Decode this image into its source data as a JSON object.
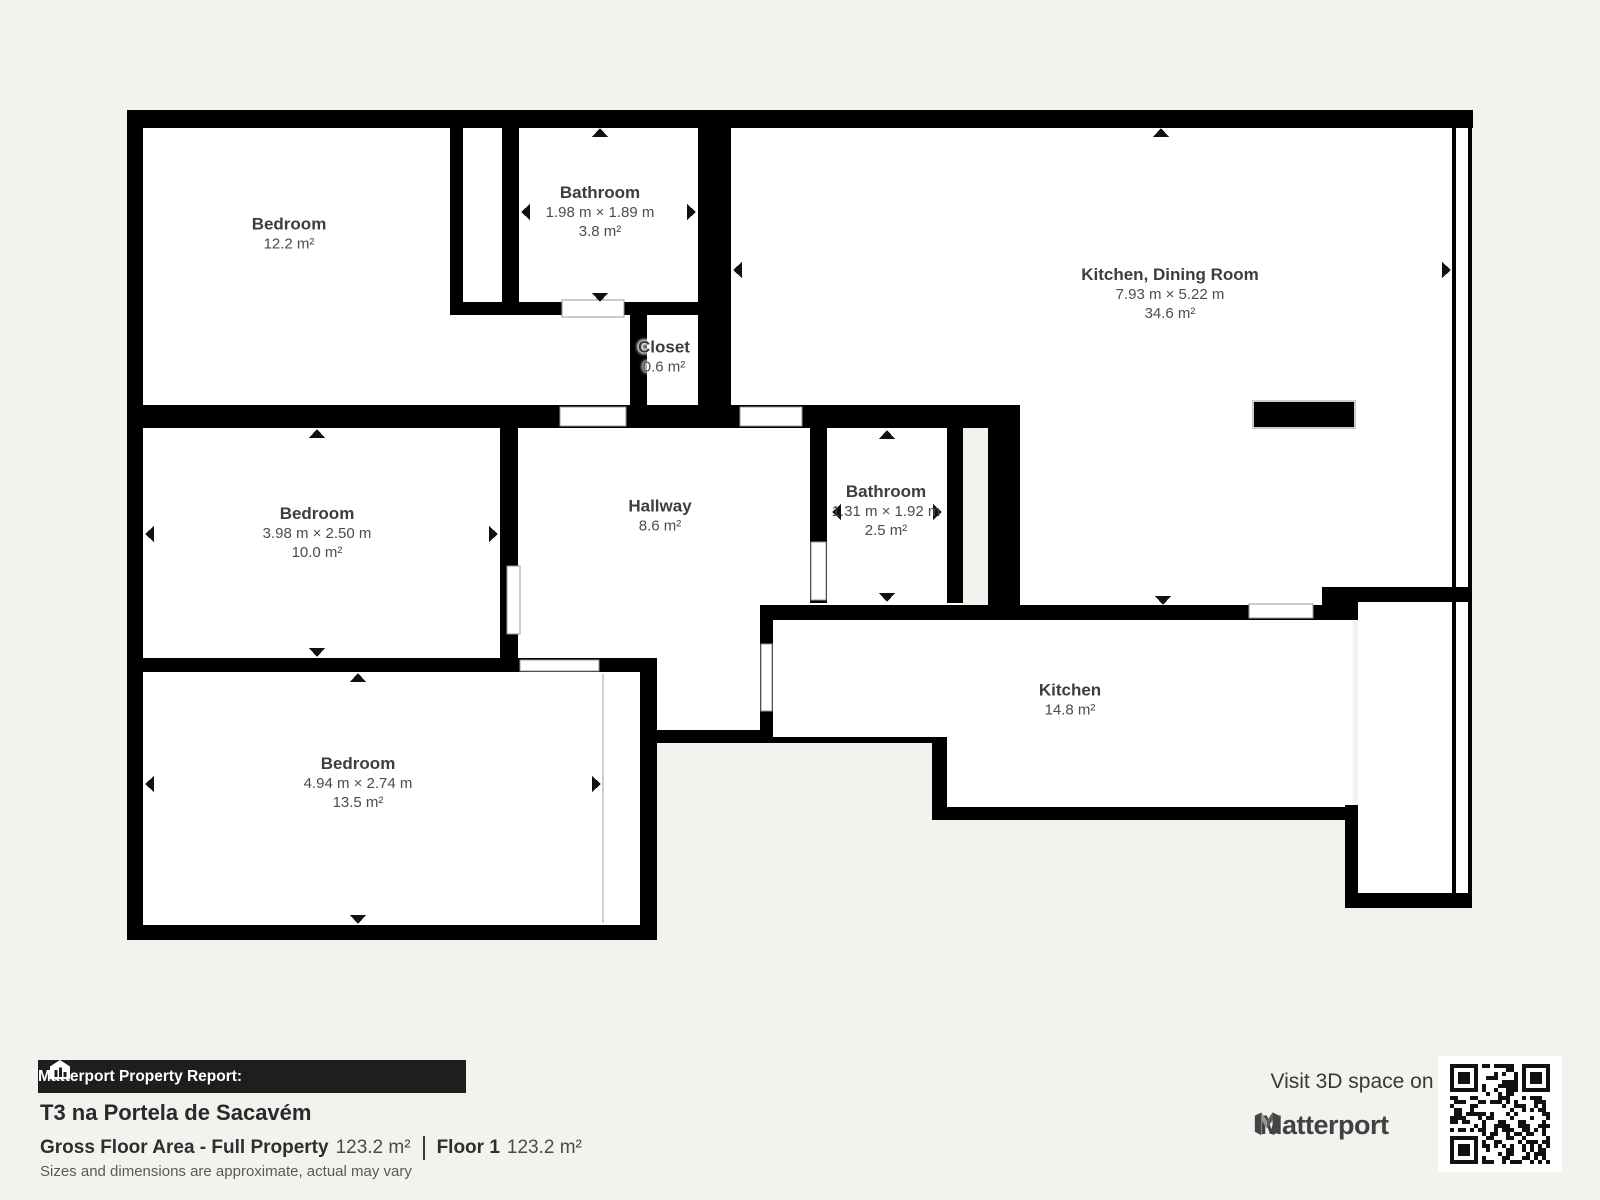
{
  "colors": {
    "background": "#f3f2ef",
    "wall": "#000000",
    "room_fill": "#ffffff",
    "label_title": "#3d3d3d",
    "label_sub": "#4c4c4c",
    "banner_bg": "#1e1e1e",
    "banner_text": "#ffffff"
  },
  "plan": {
    "rooms": [
      {
        "id": "bedroom-1",
        "name": "Bedroom",
        "dims": "",
        "area": "12.2 m²",
        "cx": 289,
        "cy": 234,
        "arrows": []
      },
      {
        "id": "bathroom-1",
        "name": "Bathroom",
        "dims": "1.98 m × 1.89 m",
        "area": "3.8 m²",
        "cx": 600,
        "cy": 212,
        "arrows": [
          [
            "up",
            600,
            128
          ],
          [
            "down",
            600,
            302
          ],
          [
            "left",
            521,
            212
          ],
          [
            "right",
            696,
            212
          ]
        ]
      },
      {
        "id": "kitchen-dining-room",
        "name": "Kitchen, Dining Room",
        "dims": "7.93 m × 5.22 m",
        "area": "34.6 m²",
        "cx": 1170,
        "cy": 294,
        "arrows": [
          [
            "up",
            1161,
            128
          ],
          [
            "down",
            1163,
            605
          ],
          [
            "left",
            733,
            270
          ],
          [
            "right",
            1451,
            270
          ]
        ]
      },
      {
        "id": "closet",
        "name": "Closet",
        "dims": "",
        "area": "0.6 m²",
        "cx": 664,
        "cy": 357,
        "halo": true,
        "arrows": []
      },
      {
        "id": "bedroom-2",
        "name": "Bedroom",
        "dims": "3.98 m × 2.50 m",
        "area": "10.0 m²",
        "cx": 317,
        "cy": 533,
        "arrows": [
          [
            "up",
            317,
            429
          ],
          [
            "down",
            317,
            657
          ],
          [
            "left",
            145,
            534
          ],
          [
            "right",
            498,
            534
          ]
        ]
      },
      {
        "id": "hallway",
        "name": "Hallway",
        "dims": "",
        "area": "8.6 m²",
        "cx": 660,
        "cy": 516,
        "arrows": []
      },
      {
        "id": "bathroom-2",
        "name": "Bathroom",
        "dims": "1.31 m × 1.92 m",
        "area": "2.5 m²",
        "cx": 886,
        "cy": 511,
        "arrows": [
          [
            "up",
            887,
            430
          ],
          [
            "down",
            887,
            602
          ],
          [
            "left",
            832,
            512
          ],
          [
            "right",
            942,
            512
          ]
        ]
      },
      {
        "id": "bedroom-3",
        "name": "Bedroom",
        "dims": "4.94 m × 2.74 m",
        "area": "13.5 m²",
        "cx": 358,
        "cy": 783,
        "arrows": [
          [
            "up",
            358,
            673
          ],
          [
            "down",
            358,
            924
          ],
          [
            "left",
            145,
            784
          ],
          [
            "right",
            601,
            784
          ]
        ]
      },
      {
        "id": "kitchen",
        "name": "Kitchen",
        "dims": "",
        "area": "14.8 m²",
        "cx": 1070,
        "cy": 700,
        "arrows": []
      }
    ]
  },
  "footer": {
    "banner_label": "Matterport Property Report:",
    "property_title": "T3 na Portela de Sacavém",
    "gfa_label": "Gross Floor Area - Full Property",
    "gfa_value": "123.2 m²",
    "floor_label": "Floor 1",
    "floor_value": "123.2 m²",
    "disclaimer": "Sizes and dimensions are approximate, actual may vary",
    "visit_text": "Visit 3D space on",
    "brand": "Matterport"
  }
}
